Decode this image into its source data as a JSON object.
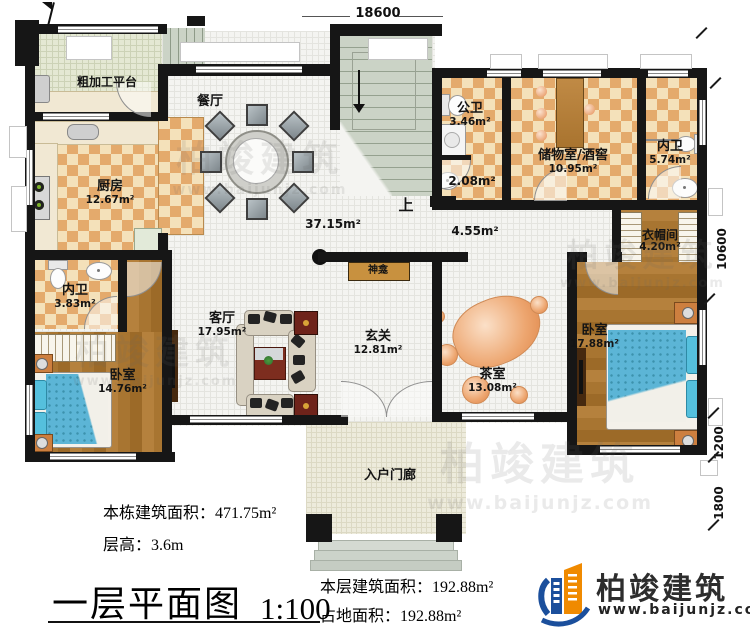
{
  "plan": {
    "dims": {
      "top": "18600",
      "right_upper": "10600",
      "right_mid": "1200",
      "right_lower": "1800"
    },
    "rooms": {
      "prep": {
        "name": "粗加工平台"
      },
      "kitchen": {
        "name": "厨房",
        "area": "12.67m²"
      },
      "dining": {
        "name": "餐厅",
        "area": "37.15m²"
      },
      "bath_left": {
        "name": "内卫",
        "area": "3.83m²"
      },
      "bedroom_left": {
        "name": "卧室",
        "area": "14.76m²"
      },
      "living": {
        "name": "客厅",
        "area": "17.95m²"
      },
      "foyer": {
        "name": "玄关",
        "area": "12.81m²"
      },
      "shrine": {
        "name": "神龛"
      },
      "stairs": {
        "name": "上"
      },
      "public_bath": {
        "name": "公卫",
        "area": "3.46m²"
      },
      "wash": {
        "area": "2.08m²"
      },
      "storage": {
        "name": "储物室/酒窖",
        "area": "10.95m²"
      },
      "bath_right": {
        "name": "内卫",
        "area": "5.74m²"
      },
      "cloak": {
        "name": "衣帽间",
        "area": "4.20m²"
      },
      "bedroom_right": {
        "name": "卧室",
        "area": "17.88m²"
      },
      "tea": {
        "name": "茶室",
        "area": "13.08m²"
      },
      "hall": {
        "area": "4.55m²"
      },
      "porch": {
        "name": "入户门廊"
      }
    },
    "stats": {
      "total_area": "本栋建筑面积：471.75m²",
      "floor_height": "层高：3.6m",
      "floor_area": "本层建筑面积：192.88m²",
      "footprint": "占地面积：192.88m²"
    },
    "title": {
      "text": "一层平面图",
      "scale": "1:100"
    },
    "brand": {
      "name": "柏竣建筑",
      "url": "www.baijunjz.com",
      "blue": "#1b4f9c",
      "orange": "#f08a00"
    },
    "watermark": {
      "text": "柏竣建筑",
      "url": "www.baijunjz.com"
    }
  }
}
